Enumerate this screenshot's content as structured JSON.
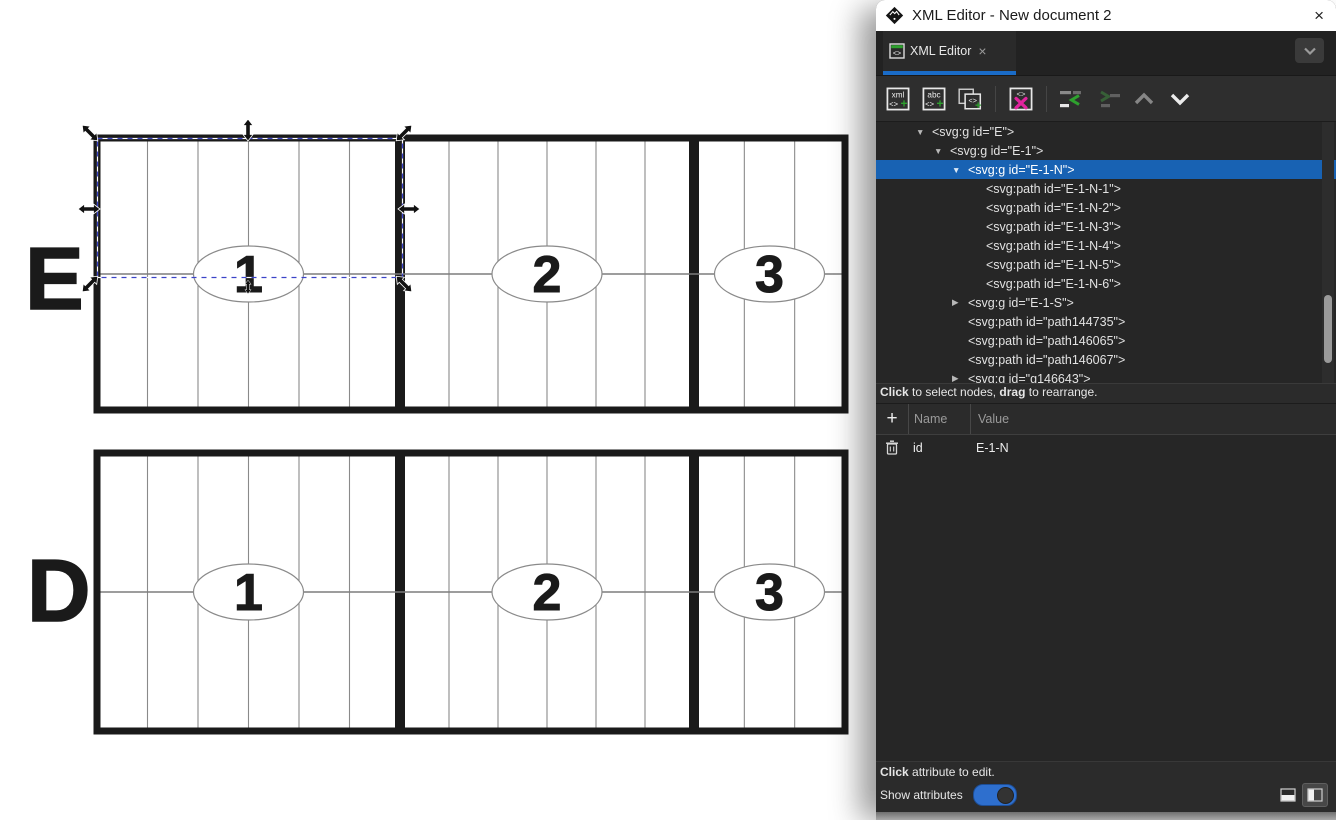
{
  "window": {
    "title": "XML Editor - New document 2"
  },
  "icons": {
    "close": "×",
    "triangle_down": "▼",
    "triangle_right": "▶",
    "plus": "+",
    "logo": "inkscape-logo",
    "chevron_down": "chevron-down"
  },
  "colors": {
    "accent_blue": "#1a6cc8",
    "selection_blue": "#1862b3",
    "toggle_blue": "#2e6fce",
    "green": "#2ea12e",
    "magenta": "#e2249e",
    "ink": "#1a1a1a",
    "thin_line": "#8a8a8a",
    "selection_dash": "#3b43c8"
  },
  "tab_bar": {
    "tab_label": "XML Editor"
  },
  "toolbar": {
    "new_element_text": "xml",
    "new_text_text": "abc",
    "code_glyph": "<>",
    "plus_glyph": "+"
  },
  "tree": {
    "items": [
      {
        "level": 1,
        "arrow": "down",
        "text": "<svg:g id=\"E\">"
      },
      {
        "level": 2,
        "arrow": "down",
        "text": "<svg:g id=\"E-1\">"
      },
      {
        "level": 3,
        "arrow": "down",
        "selected": true,
        "text": "<svg:g id=\"E-1-N\">"
      },
      {
        "level": 4,
        "text": "<svg:path id=\"E-1-N-1\">"
      },
      {
        "level": 4,
        "text": "<svg:path id=\"E-1-N-2\">"
      },
      {
        "level": 4,
        "text": "<svg:path id=\"E-1-N-3\">"
      },
      {
        "level": 4,
        "text": "<svg:path id=\"E-1-N-4\">"
      },
      {
        "level": 4,
        "text": "<svg:path id=\"E-1-N-5\">"
      },
      {
        "level": 4,
        "text": "<svg:path id=\"E-1-N-6\">"
      },
      {
        "level": 3,
        "arrow": "right",
        "text": "<svg:g id=\"E-1-S\">"
      },
      {
        "level": 3,
        "text": "<svg:path id=\"path144735\">"
      },
      {
        "level": 3,
        "text": "<svg:path id=\"path146065\">"
      },
      {
        "level": 3,
        "text": "<svg:path id=\"path146067\">"
      },
      {
        "level": 3,
        "arrow": "right",
        "text": "<svg:g id=\"g146643\">"
      }
    ]
  },
  "status_bar": {
    "parts": [
      {
        "t": "Click",
        "b": true
      },
      {
        "t": " to select nodes, "
      },
      {
        "t": "drag",
        "b": true
      },
      {
        "t": " to rearrange."
      }
    ]
  },
  "attributes": {
    "headers": {
      "name": "Name",
      "value": "Value"
    },
    "rows": [
      {
        "name": "id",
        "value": "E-1-N"
      }
    ]
  },
  "footer": {
    "hint_parts": [
      {
        "t": "Click",
        "b": true
      },
      {
        "t": " attribute to edit."
      }
    ],
    "toggle_label": "Show attributes",
    "toggle_on": true
  },
  "canvas": {
    "rows": [
      {
        "label": "E",
        "label_x": 25,
        "label_baseline": 309,
        "band": {
          "x": 97,
          "y": 138,
          "w": 748,
          "h": 272
        },
        "sections": [
          {
            "cols": 6,
            "w": 303,
            "num": "1"
          },
          {
            "cols": 6,
            "w": 294,
            "num": "2"
          },
          {
            "cols": 3,
            "w": 151,
            "num": "3"
          }
        ]
      },
      {
        "label": "D",
        "label_x": 27,
        "label_baseline": 621,
        "band": {
          "x": 97,
          "y": 453,
          "w": 748,
          "h": 278
        },
        "sections": [
          {
            "cols": 6,
            "w": 303,
            "num": "1"
          },
          {
            "cols": 6,
            "w": 294,
            "num": "2"
          },
          {
            "cols": 3,
            "w": 151,
            "num": "3"
          }
        ]
      }
    ],
    "ellipse": {
      "rx": 55,
      "ry": 28
    },
    "selection": {
      "x": 97.5,
      "y": 138.5,
      "w": 305,
      "h": 139,
      "handles": [
        {
          "name": "nw",
          "x": 90,
          "y": 133,
          "angle": 45
        },
        {
          "name": "n",
          "x": 248,
          "y": 130,
          "angle": 90
        },
        {
          "name": "ne",
          "x": 404,
          "y": 133,
          "angle": -45
        },
        {
          "name": "w",
          "x": 89,
          "y": 209,
          "angle": 0
        },
        {
          "name": "e",
          "x": 409,
          "y": 209,
          "angle": 0
        },
        {
          "name": "sw",
          "x": 90,
          "y": 284,
          "angle": -45
        },
        {
          "name": "s",
          "x": 248,
          "y": 287,
          "angle": 90,
          "scale": 0.62
        },
        {
          "name": "se",
          "x": 404,
          "y": 284,
          "angle": 45
        }
      ]
    }
  }
}
